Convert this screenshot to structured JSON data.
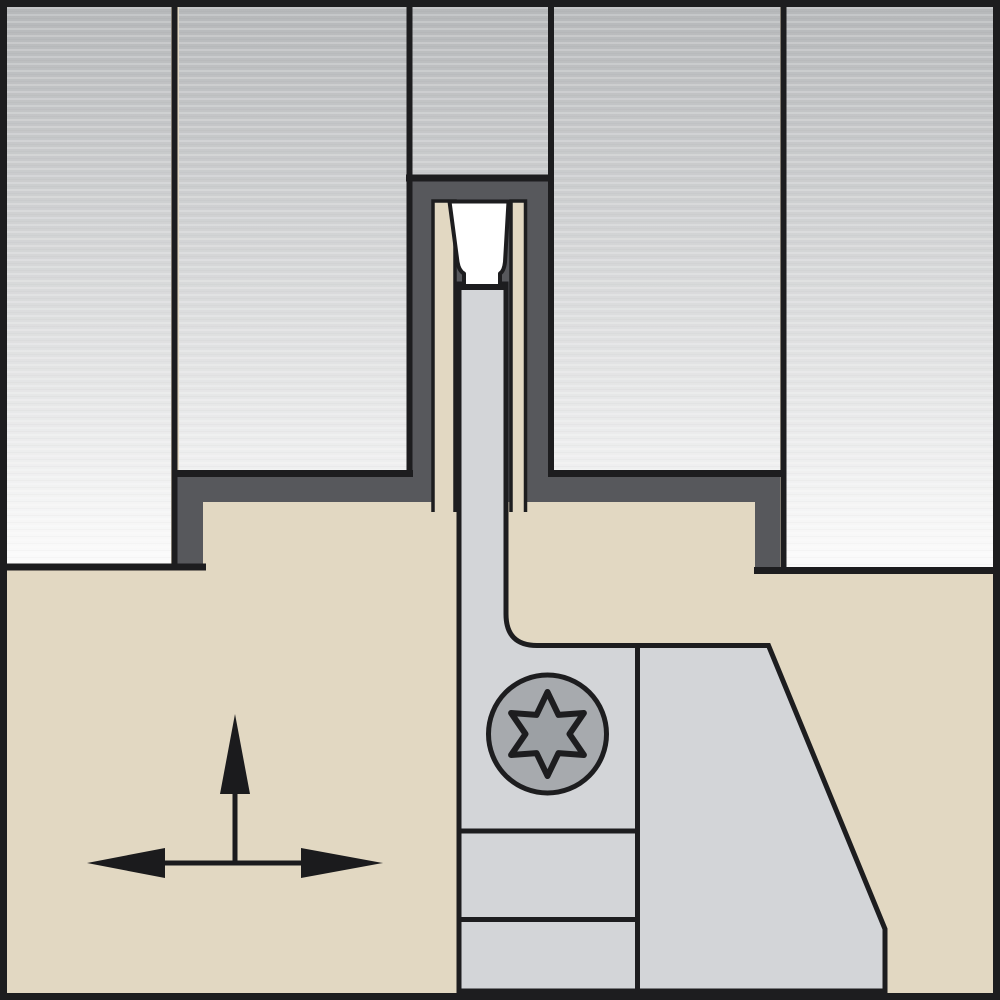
{
  "diagram": {
    "kind": "technical-illustration",
    "subject": "grooving-toolholder-in-workpiece-cross-section",
    "parts": {
      "workpiece": "sectioned gray part with machined groove",
      "groove_surface": "dark gray stepped groove profile",
      "toolholder": "tan holder body",
      "blade": "light gray support blade",
      "insert": "white grooving insert",
      "screw": "torx clamp screw",
      "arrows": "feed direction indicators"
    },
    "arrows": {
      "vertical_direction": "up",
      "horizontal_direction": "left-right"
    }
  },
  "palette": {
    "frame": "#1d1d1f",
    "outline": "#1d1d1f",
    "workpiece_gradient_top": "#b6b8ba",
    "workpiece_gradient_bottom": "#fcfcfc",
    "groove_surface": "#57585c",
    "holder_tan": "#e2d8c2",
    "blade_gray": "#d3d5d8",
    "insert_white": "#ffffff",
    "screw_head": "#a7aaae",
    "screw_socket": "#9ca0a4",
    "arrow_black": "#1b1b1d"
  }
}
